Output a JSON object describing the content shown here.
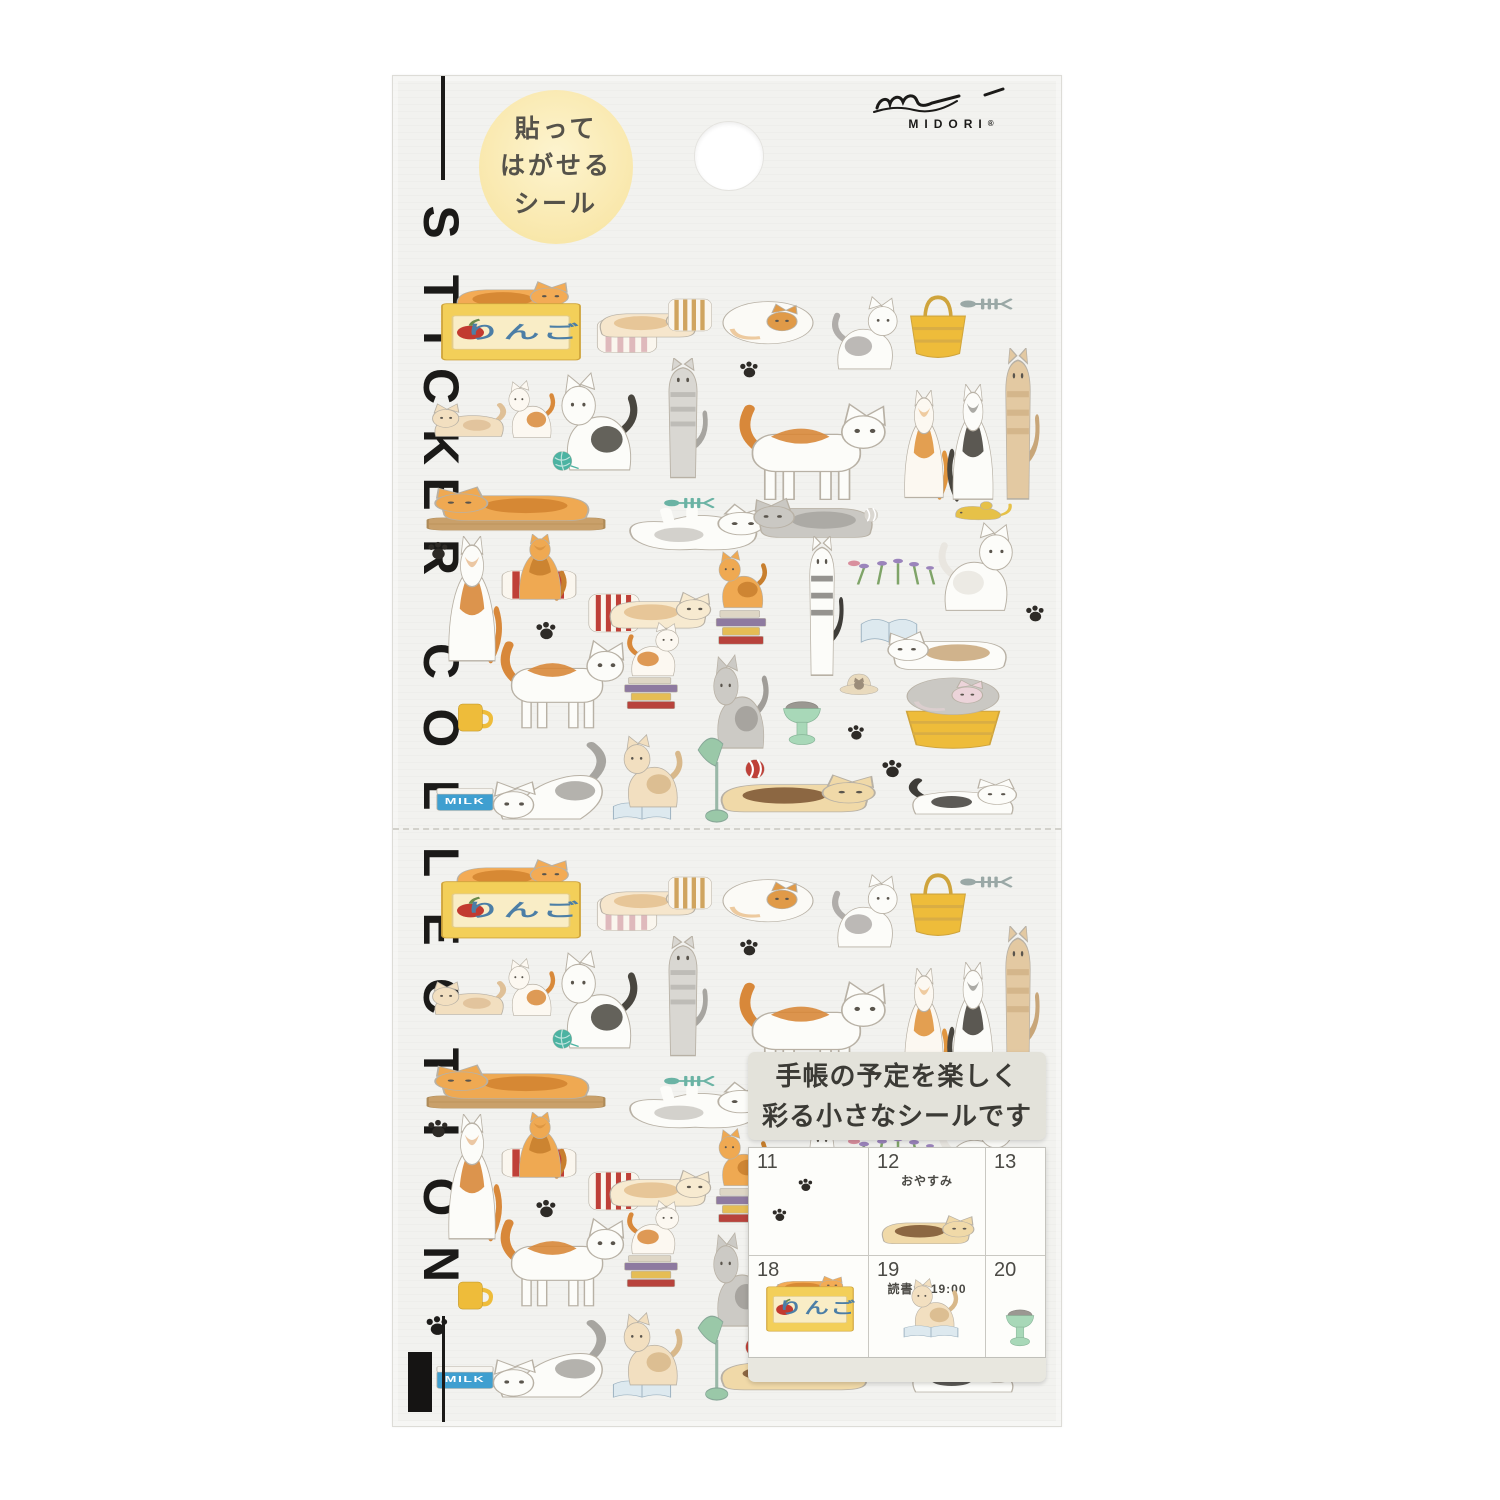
{
  "brand": {
    "name": "MIDORI",
    "reg": "®"
  },
  "badge": {
    "lines": [
      "貼って",
      "はがせる",
      "シール"
    ]
  },
  "vertical_title": "STICKER COLLECTION",
  "info": {
    "lines": [
      "手帳の予定を楽しく",
      "彩る小さなシールです"
    ]
  },
  "calendar": {
    "days": [
      {
        "n": "11",
        "note": ""
      },
      {
        "n": "12",
        "note": "おやすみ"
      },
      {
        "n": "13",
        "note": ""
      },
      {
        "n": "18",
        "note": "ヨガ 11:00"
      },
      {
        "n": "19",
        "note": "読書会 19:00"
      },
      {
        "n": "20",
        "note": ""
      }
    ]
  },
  "labels": {
    "apple_box": "りんご",
    "milk": "MILK"
  },
  "colors": {
    "sheet": "#f2f2ef",
    "badge_yellow": "#f9e8ad",
    "box_yellow": "#f3cf59",
    "tabby_orange": "#efa952",
    "teal": "#4cb3a2",
    "stripe_red": "#bf4038",
    "milk_blue": "#3f9fd0",
    "paw_black": "#2e2b27",
    "bowl_green": "#a8d8b8"
  },
  "stickers": [
    {
      "s": "catLie",
      "x": 446,
      "y": 262,
      "w": 126,
      "h": 58,
      "c2": "#f3ab55",
      "c1": "#d1832f"
    },
    {
      "s": "boxApple",
      "x": 436,
      "y": 290,
      "w": 150,
      "h": 76,
      "c1": "#f3cf59",
      "lb": "apple_box",
      "tx": 58,
      "ty": 64,
      "fs": 24,
      "tc": "#4c7ea6"
    },
    {
      "s": "pillowStriped",
      "x": 594,
      "y": 314,
      "w": 66,
      "h": 44,
      "c1": "#dfb9bc"
    },
    {
      "s": "catLie",
      "x": 590,
      "y": 286,
      "w": 114,
      "h": 58,
      "c2": "#f6e6cc",
      "c1": "#e4bf8e"
    },
    {
      "s": "pillowStriped",
      "x": 666,
      "y": 294,
      "w": 48,
      "h": 42,
      "c1": "#d0a45e"
    },
    {
      "s": "catCurl",
      "x": 718,
      "y": 288,
      "w": 100,
      "h": 62,
      "c2": "#fbfaf6",
      "c1": "#e09a48"
    },
    {
      "s": "catSit",
      "x": 828,
      "y": 296,
      "w": 76,
      "h": 76,
      "c2": "#fcfcf9",
      "c1": "#b0adaa",
      "flip": true
    },
    {
      "s": "basket",
      "x": 902,
      "y": 288,
      "w": 72,
      "h": 78,
      "c1": "#eebc3a"
    },
    {
      "s": "fishbone",
      "x": 958,
      "y": 288,
      "w": 56,
      "h": 32,
      "c1": "#9aa8a6"
    },
    {
      "s": "paw",
      "x": 738,
      "y": 358,
      "w": 22,
      "h": 22,
      "c1": "#2e2b27"
    },
    {
      "s": "catCrouch",
      "x": 426,
      "y": 386,
      "w": 82,
      "h": 56,
      "c2": "#f2dfc0",
      "c1": "#dfc097"
    },
    {
      "s": "catSit",
      "x": 504,
      "y": 380,
      "w": 54,
      "h": 60,
      "c2": "#fcf8f1",
      "c1": "#d8893a"
    },
    {
      "s": "catSit",
      "x": 554,
      "y": 372,
      "w": 88,
      "h": 102,
      "c2": "#fcfcf9",
      "c1": "#49463f"
    },
    {
      "s": "yarn",
      "x": 546,
      "y": 444,
      "w": 34,
      "h": 34,
      "c1": "#4cb3a2"
    },
    {
      "s": "catStretchV",
      "x": 644,
      "y": 358,
      "w": 78,
      "h": 122,
      "c2": "#d9d7d2",
      "c1": "#a7a5a0"
    },
    {
      "s": "catWalk",
      "x": 734,
      "y": 388,
      "w": 154,
      "h": 116,
      "c2": "#fcfcf9",
      "c1": "#d8883a"
    },
    {
      "s": "catBack",
      "x": 894,
      "y": 390,
      "w": 60,
      "h": 112,
      "c2": "#fcf8f1",
      "c1": "#e0953f"
    },
    {
      "s": "catBack",
      "x": 942,
      "y": 384,
      "w": 62,
      "h": 120,
      "c2": "#fcfcf9",
      "c1": "#49463f",
      "flip": true
    },
    {
      "s": "catStretchV",
      "x": 984,
      "y": 348,
      "w": 68,
      "h": 154,
      "c2": "#e3c9a2",
      "c1": "#c8a679"
    },
    {
      "s": "bar",
      "x": 424,
      "y": 510,
      "w": 184,
      "h": 28,
      "c1": "#c9a06a"
    },
    {
      "s": "catLie",
      "x": 430,
      "y": 466,
      "w": 174,
      "h": 62,
      "c2": "#efa952",
      "c1": "#d1832f",
      "flip": true
    },
    {
      "s": "catOnBack",
      "x": 610,
      "y": 482,
      "w": 164,
      "h": 80,
      "c2": "#fcfcf9",
      "c1": "#b7b4ae"
    },
    {
      "s": "fishbone",
      "x": 662,
      "y": 488,
      "w": 54,
      "h": 30,
      "c1": "#6ab3a4"
    },
    {
      "s": "catLie",
      "x": 750,
      "y": 474,
      "w": 134,
      "h": 72,
      "c2": "#cac8c3",
      "c1": "#a7a5a0",
      "flip": true
    },
    {
      "s": "ball",
      "x": 860,
      "y": 504,
      "w": 22,
      "h": 22,
      "c1": "#dad7d1"
    },
    {
      "s": "mouse",
      "x": 948,
      "y": 488,
      "w": 66,
      "h": 44,
      "c1": "#e6c148"
    },
    {
      "s": "plant",
      "x": 844,
      "y": 544,
      "w": 100,
      "h": 46
    },
    {
      "s": "catSit",
      "x": 934,
      "y": 522,
      "w": 86,
      "h": 92,
      "c2": "#fcfcf9",
      "c1": "#e9e6e0",
      "flip": true
    },
    {
      "s": "paw",
      "x": 426,
      "y": 538,
      "w": 24,
      "h": 24,
      "c1": "#2e2b27"
    },
    {
      "s": "catBack",
      "x": 436,
      "y": 536,
      "w": 72,
      "h": 130,
      "c2": "#fcfcf9",
      "c1": "#d8883a"
    },
    {
      "s": "pillowStriped",
      "x": 498,
      "y": 566,
      "w": 82,
      "h": 38,
      "c1": "#bf4038"
    },
    {
      "s": "catBack",
      "x": 508,
      "y": 534,
      "w": 64,
      "h": 68,
      "c2": "#efa952",
      "c1": "#c87f2e"
    },
    {
      "s": "pillowStriped",
      "x": 586,
      "y": 588,
      "w": 56,
      "h": 50,
      "c1": "#bf4038"
    },
    {
      "s": "catLie",
      "x": 600,
      "y": 570,
      "w": 114,
      "h": 66,
      "c2": "#f7ead0",
      "c1": "#e4bf8e"
    },
    {
      "s": "books",
      "x": 710,
      "y": 596,
      "w": 62,
      "h": 56
    },
    {
      "s": "catSit",
      "x": 714,
      "y": 550,
      "w": 56,
      "h": 60,
      "c2": "#efa952",
      "c1": "#c87f2e"
    },
    {
      "s": "catStretchV",
      "x": 788,
      "y": 536,
      "w": 68,
      "h": 142,
      "c2": "#fcfcf9",
      "c1": "#3f3d39"
    },
    {
      "s": "bookOpen",
      "x": 856,
      "y": 604,
      "w": 66,
      "h": 56,
      "c1": "#dde9ef"
    },
    {
      "s": "catLie",
      "x": 884,
      "y": 608,
      "w": 134,
      "h": 70,
      "c2": "#fcfcf9",
      "c1": "#c8a679",
      "flip": true
    },
    {
      "s": "paw",
      "x": 1024,
      "y": 602,
      "w": 22,
      "h": 22,
      "c1": "#2e2b27"
    },
    {
      "s": "paw",
      "x": 534,
      "y": 618,
      "w": 24,
      "h": 24,
      "c1": "#2e2b27"
    },
    {
      "s": "mug",
      "x": 448,
      "y": 690,
      "w": 52,
      "h": 54,
      "c1": "#eebc3a"
    },
    {
      "s": "catWalk",
      "x": 496,
      "y": 626,
      "w": 130,
      "h": 106,
      "c2": "#fcfcf9",
      "c1": "#d8883a"
    },
    {
      "s": "books",
      "x": 618,
      "y": 664,
      "w": 66,
      "h": 52
    },
    {
      "s": "catSit",
      "x": 624,
      "y": 622,
      "w": 60,
      "h": 56,
      "c2": "#fcf8f1",
      "c1": "#d8883a",
      "flip": true
    },
    {
      "s": "catSit",
      "x": 708,
      "y": 654,
      "w": 64,
      "h": 98,
      "c2": "#cccac5",
      "c1": "#a09d98"
    },
    {
      "s": "bowlPedestal",
      "x": 774,
      "y": 690,
      "w": 56,
      "h": 62,
      "c1": "#a8d8b8"
    },
    {
      "s": "hatCat",
      "x": 834,
      "y": 662,
      "w": 50,
      "h": 46,
      "c1": "#e9dabd"
    },
    {
      "s": "basket",
      "x": 892,
      "y": 686,
      "w": 122,
      "h": 70,
      "c1": "#eebc3a"
    },
    {
      "s": "catCurl",
      "x": 902,
      "y": 666,
      "w": 102,
      "h": 54,
      "c2": "#cac8c3",
      "c1": "#ecd4da"
    },
    {
      "s": "paw",
      "x": 846,
      "y": 722,
      "w": 20,
      "h": 20,
      "c1": "#2e2b27"
    },
    {
      "s": "paw",
      "x": 880,
      "y": 756,
      "w": 24,
      "h": 24,
      "c1": "#2e2b27"
    },
    {
      "s": "milk",
      "x": 426,
      "y": 774,
      "w": 78,
      "h": 48,
      "c1": "#3f9fd0",
      "lb": "milk",
      "tx": 50,
      "ty": 62,
      "fs": 18,
      "tc": "#ffffff"
    },
    {
      "s": "catPounce",
      "x": 484,
      "y": 738,
      "w": 134,
      "h": 88,
      "c2": "#fcfcf9",
      "c1": "#a7a5a0"
    },
    {
      "s": "bookOpen",
      "x": 608,
      "y": 792,
      "w": 68,
      "h": 40,
      "c1": "#dde9ef"
    },
    {
      "s": "catSit",
      "x": 618,
      "y": 734,
      "w": 68,
      "h": 76,
      "c2": "#f2dfc0",
      "c1": "#d8b88a"
    },
    {
      "s": "lamp",
      "x": 682,
      "y": 728,
      "w": 62,
      "h": 100,
      "c1": "#9ac8a8"
    },
    {
      "s": "ball",
      "x": 740,
      "y": 754,
      "w": 30,
      "h": 30,
      "c1": "#bf4038"
    },
    {
      "s": "catLie",
      "x": 706,
      "y": 752,
      "w": 174,
      "h": 68,
      "c2": "#f0d9a8",
      "c1": "#7a5230"
    },
    {
      "s": "catCrouch",
      "x": 906,
      "y": 760,
      "w": 120,
      "h": 60,
      "c2": "#fcfcf9",
      "c1": "#3f3d39",
      "flip": true
    }
  ],
  "extras": [
    {
      "s": "paw",
      "x": 424,
      "y": 1312,
      "w": 26,
      "h": 26,
      "c1": "#1d1c1a"
    }
  ],
  "sample_stickers": [
    {
      "s": "paw",
      "x": 48,
      "y": 28,
      "w": 17,
      "h": 17,
      "c1": "#2e2b27"
    },
    {
      "s": "paw",
      "x": 22,
      "y": 58,
      "w": 17,
      "h": 17,
      "c1": "#2e2b27"
    },
    {
      "s": "catLie",
      "x": 124,
      "y": 50,
      "w": 104,
      "h": 52,
      "c2": "#f0d9a8",
      "c1": "#7a5230"
    },
    {
      "s": "catLie",
      "x": 20,
      "y": 116,
      "w": 76,
      "h": 36,
      "c2": "#f3ab55",
      "c1": "#d1832f"
    },
    {
      "s": "boxApple",
      "x": 14,
      "y": 128,
      "w": 94,
      "h": 60,
      "c1": "#f3cf59",
      "lb": "apple_box",
      "tx": 58,
      "ty": 62,
      "fs": 26,
      "tc": "#4c7ea6"
    },
    {
      "s": "catSit",
      "x": 158,
      "y": 130,
      "w": 54,
      "h": 56,
      "c2": "#f2dfc0",
      "c1": "#d8b88a"
    },
    {
      "s": "bookOpen",
      "x": 150,
      "y": 170,
      "w": 64,
      "h": 28,
      "c1": "#dde9ef"
    },
    {
      "s": "bowlPedestal",
      "x": 250,
      "y": 152,
      "w": 42,
      "h": 52,
      "c1": "#a8d8b8"
    }
  ]
}
